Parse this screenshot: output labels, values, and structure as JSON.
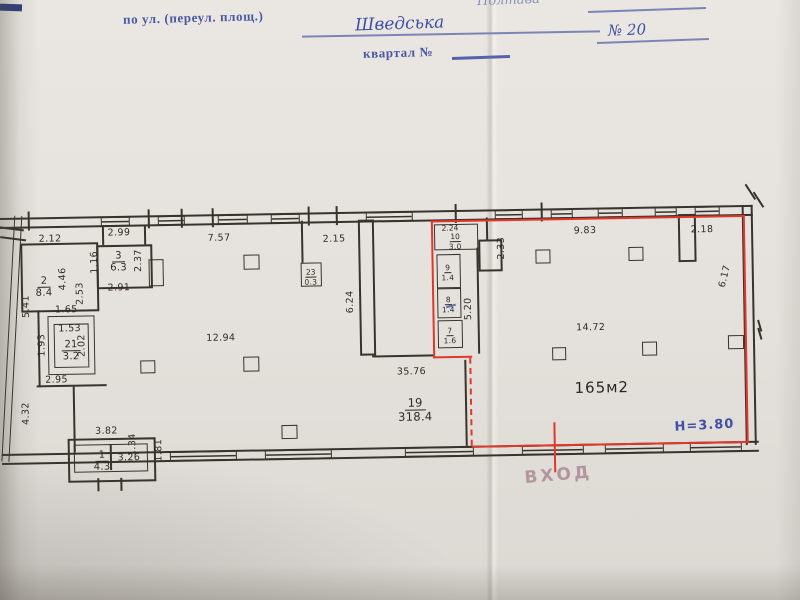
{
  "header": {
    "city": "Полтава",
    "street_label": "по ул. (переул. площ.)",
    "street_value": "Шведська",
    "number_sign": "№",
    "number_value": "20",
    "block_label": "квартал №"
  },
  "plan": {
    "dims": {
      "d2_12": "2.12",
      "d2_99": "2.99",
      "d1_16": "1.16",
      "d2_37": "2.37",
      "d4_46": "4.46",
      "d2_53": "2.53",
      "d2_91": "2.91",
      "d1_65": "1.65",
      "d1_53": "1.53",
      "d2_02": "2.02",
      "d1_93": "1.93",
      "d2_95": "2.95",
      "d5_41": "5.41",
      "d4_32": "4.32",
      "d3_82": "3.82",
      "d3_26": "3.26",
      "d1_34": "1.34",
      "d1_81": "1.81",
      "d7_57": "7.57",
      "d12_94": "12.94",
      "d2_15": "2.15",
      "d6_24": "6.24",
      "d35_76": "35.76",
      "d2_24": "2.24",
      "d5_20": "5.20",
      "d2_33": "2.33",
      "d9_83": "9.83",
      "d2_18": "2.18",
      "d6_17": "6.17",
      "d14_72": "14.72"
    },
    "rooms": {
      "r1": {
        "num": "1",
        "area": "4.3"
      },
      "r2": {
        "num": "2",
        "area": "8.4"
      },
      "r3": {
        "num": "3",
        "area": "6.3"
      },
      "r7": {
        "num": "7",
        "area": "1.6"
      },
      "r8": {
        "num": "8",
        "area": "1.4"
      },
      "r9": {
        "num": "9",
        "area": "1.4"
      },
      "r10": {
        "num": "10",
        "area": "3.0"
      },
      "r19": {
        "num": "19",
        "area": "318.4"
      },
      "r21": {
        "num": "21",
        "area": "3.2"
      },
      "r23": {
        "num": "23",
        "area": "0.3"
      }
    },
    "annotations": {
      "area_marked": "165м2",
      "height": "Н=3.80",
      "entrance": "ВХОД"
    },
    "colors": {
      "highlight_red": "#e0382b",
      "ink_blue": "#3f4fa2",
      "marker_pink": "#a8858f",
      "line_black": "#38332c"
    }
  }
}
